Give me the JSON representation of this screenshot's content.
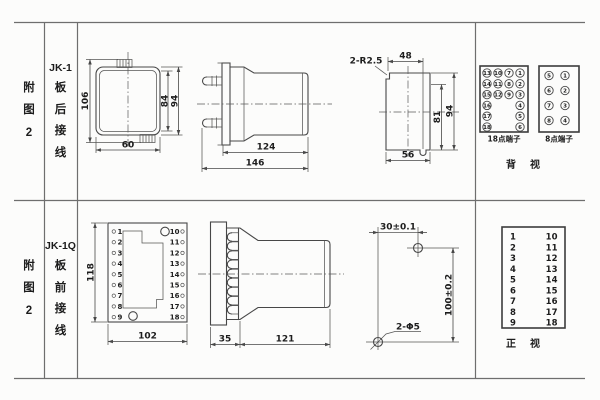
{
  "rows": [
    {
      "fig": [
        "附",
        "图",
        "2"
      ],
      "model": "JK-1",
      "wiring": [
        "板",
        "后",
        "接",
        "线"
      ],
      "drawings": {
        "rear_view": {
          "dim_height_overall": "106",
          "dim_height_inner": "84",
          "dim_height_outer": "94",
          "dim_width": "60"
        },
        "side_view": {
          "dim_body_length": "124",
          "dim_total_length": "146"
        },
        "panel_cutout": {
          "dim_corner_radius": "2-R2.5",
          "dim_top_width": "48",
          "dim_inner_height": "81",
          "dim_outer_height": "94",
          "dim_bottom_width": "56"
        }
      },
      "terminal_block_18": {
        "caption": "18点端子",
        "col1": [
          "13",
          "14",
          "15",
          "16",
          "17",
          "18"
        ],
        "col2": [
          "10",
          "11",
          "12"
        ],
        "col3": [
          "7",
          "8",
          "9"
        ],
        "col4": [
          "1",
          "2",
          "3",
          "4",
          "5",
          "6"
        ]
      },
      "terminal_block_8": {
        "caption": "8点端子",
        "col1": [
          "5",
          "6",
          "7",
          "8"
        ],
        "col2": [
          "1",
          "2",
          "3",
          "4"
        ]
      },
      "view_label": "背　视"
    },
    {
      "fig": [
        "附",
        "图",
        "2"
      ],
      "model": "JK-1Q",
      "wiring": [
        "板",
        "前",
        "接",
        "线"
      ],
      "drawings": {
        "front_view": {
          "dim_height": "118",
          "dim_width": "102",
          "terms_left": [
            "1",
            "2",
            "3",
            "4",
            "5",
            "6",
            "7",
            "8",
            "9"
          ],
          "terms_right": [
            "10",
            "11",
            "12",
            "13",
            "14",
            "15",
            "16",
            "17",
            "18"
          ]
        },
        "side_view": {
          "dim_flange": "35",
          "dim_body": "121"
        },
        "drill_pattern": {
          "dim_horizontal": "30±0.1",
          "dim_vertical": "100±0.2",
          "dim_holes": "2-Φ5"
        }
      },
      "terminal_panel": {
        "left": [
          "1",
          "2",
          "3",
          "4",
          "5",
          "6",
          "7",
          "8",
          "9"
        ],
        "right": [
          "10",
          "11",
          "12",
          "13",
          "14",
          "15",
          "16",
          "17",
          "18"
        ]
      },
      "view_label": "正　视"
    }
  ]
}
